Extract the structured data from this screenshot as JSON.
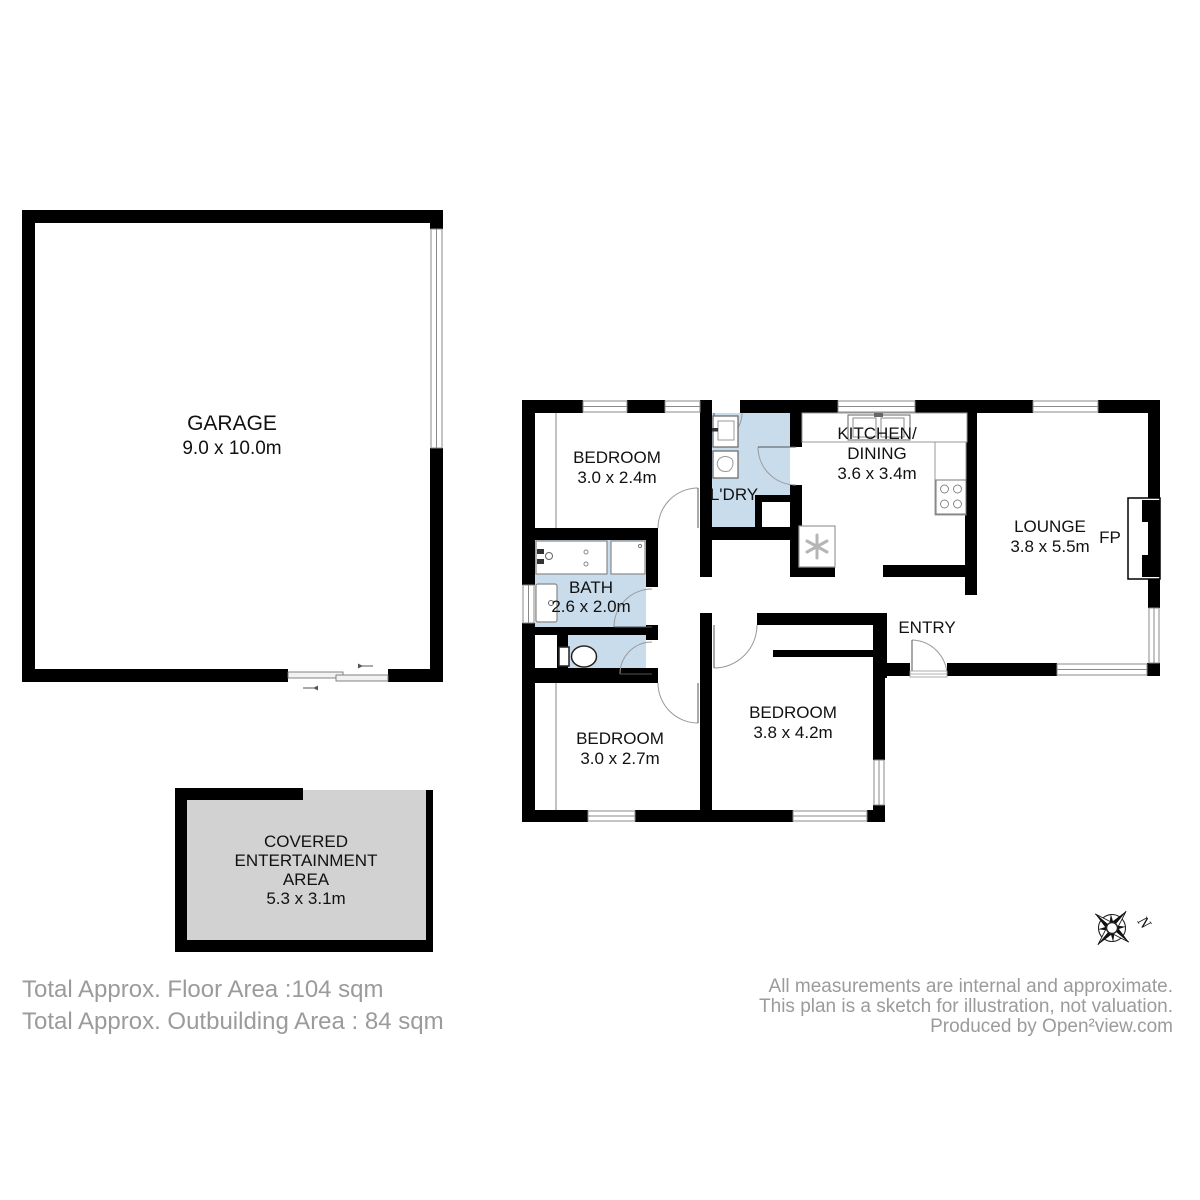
{
  "rooms": {
    "garage": {
      "name": "GARAGE",
      "dims": "9.0 x 10.0m"
    },
    "bedroom_top": {
      "name": "BEDROOM",
      "dims": "3.0 x 2.4m"
    },
    "laundry": {
      "name": "L'DRY"
    },
    "kitchen": {
      "name1": "KITCHEN/",
      "name2": "DINING",
      "dims": "3.6 x 3.4m"
    },
    "lounge": {
      "name": "LOUNGE",
      "dims": "3.8 x 5.5m"
    },
    "fireplace": {
      "abbr": "FP"
    },
    "entry": {
      "name": "ENTRY"
    },
    "bath": {
      "name": "BATH",
      "dims": "2.6 x 2.0m"
    },
    "bedroom_mid": {
      "name": "BEDROOM",
      "dims": "3.8 x 4.2m"
    },
    "bedroom_bottom": {
      "name": "BEDROOM",
      "dims": "3.0 x 2.7m"
    },
    "covered_area": {
      "name_line1": "COVERED",
      "name_line2": "ENTERTAINMENT",
      "name_line3": "AREA",
      "dims": "5.3 x 3.1m"
    }
  },
  "totals": {
    "floor_area": "Total Approx. Floor Area :104 sqm",
    "outbuilding_area": "Total Approx. Outbuilding Area : 84 sqm"
  },
  "disclaimer": {
    "line1": "All measurements are internal and approximate.",
    "line2": "This plan is a sketch for illustration, not valuation.",
    "line3": "Produced by Open²view.com"
  },
  "compass": {
    "north_label": "N"
  },
  "colors": {
    "wall": "#000000",
    "wet_area_fill": "#c9dcec",
    "outdoor_fill": "#d2d2d2",
    "window_frame": "#8a8a8a",
    "room_text": "#111111",
    "annotation_text": "#9b9b9b"
  }
}
